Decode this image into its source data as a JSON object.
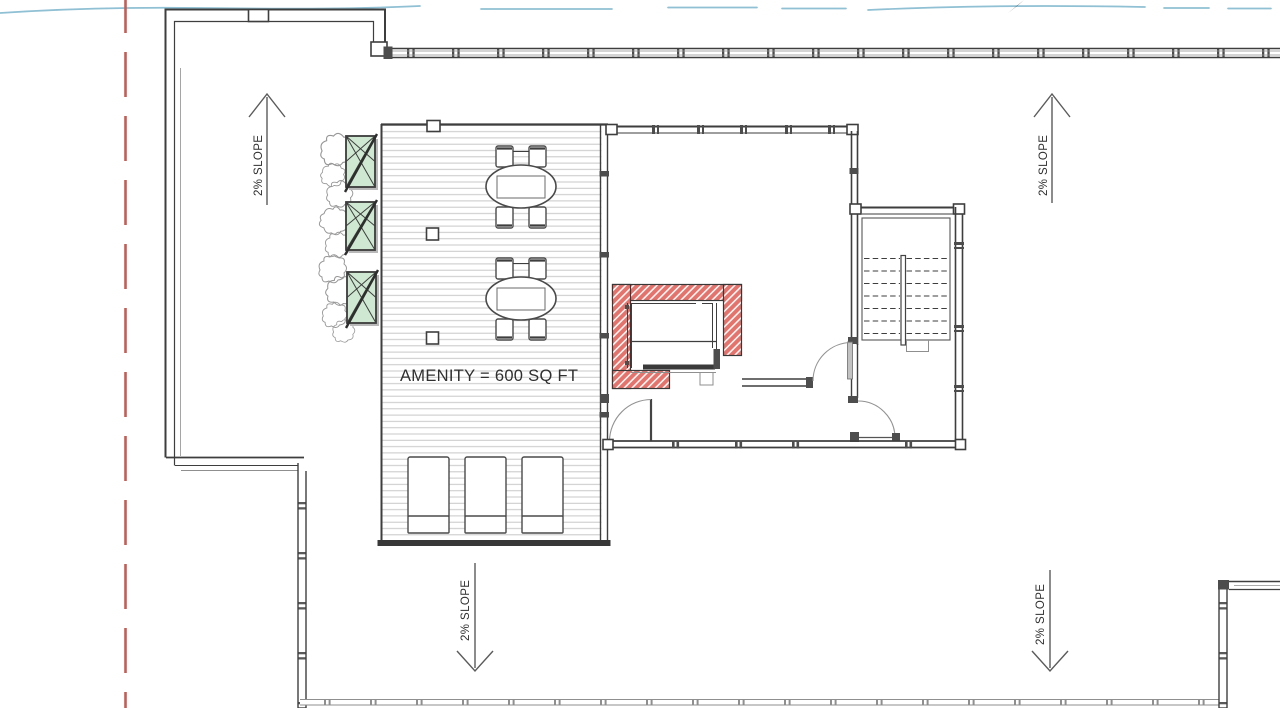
{
  "plan": {
    "area_label": "AMENITY = 600 SQ FT",
    "slope_labels": [
      {
        "id": "upper-left",
        "text": "2% SLOPE",
        "direction": "up"
      },
      {
        "id": "upper-right",
        "text": "2% SLOPE",
        "direction": "up"
      },
      {
        "id": "lower-left",
        "text": "2% SLOPE",
        "direction": "down"
      },
      {
        "id": "lower-right",
        "text": "2% SLOPE",
        "direction": "down"
      }
    ],
    "features": {
      "dining_tables": 2,
      "chairs_per_table": 4,
      "lounge_chairs": 3,
      "planters": 3
    }
  },
  "colors": {
    "wall": "#3e3e3e",
    "wall-light": "#8f8f8f",
    "joint": "#4d4d4d",
    "deck-stripe": "#c8c8c8",
    "hatch-red": "#e5736c",
    "hatch-line": "#ffffff",
    "planter-green": "#cfe8d1",
    "revision-cyan": "#8fc0d3",
    "property-red": "#c75b55",
    "text": "#2f2f2f",
    "arrow": "#5b5b5b",
    "door-arc": "#929292",
    "shadow": "#b9b9b9"
  }
}
